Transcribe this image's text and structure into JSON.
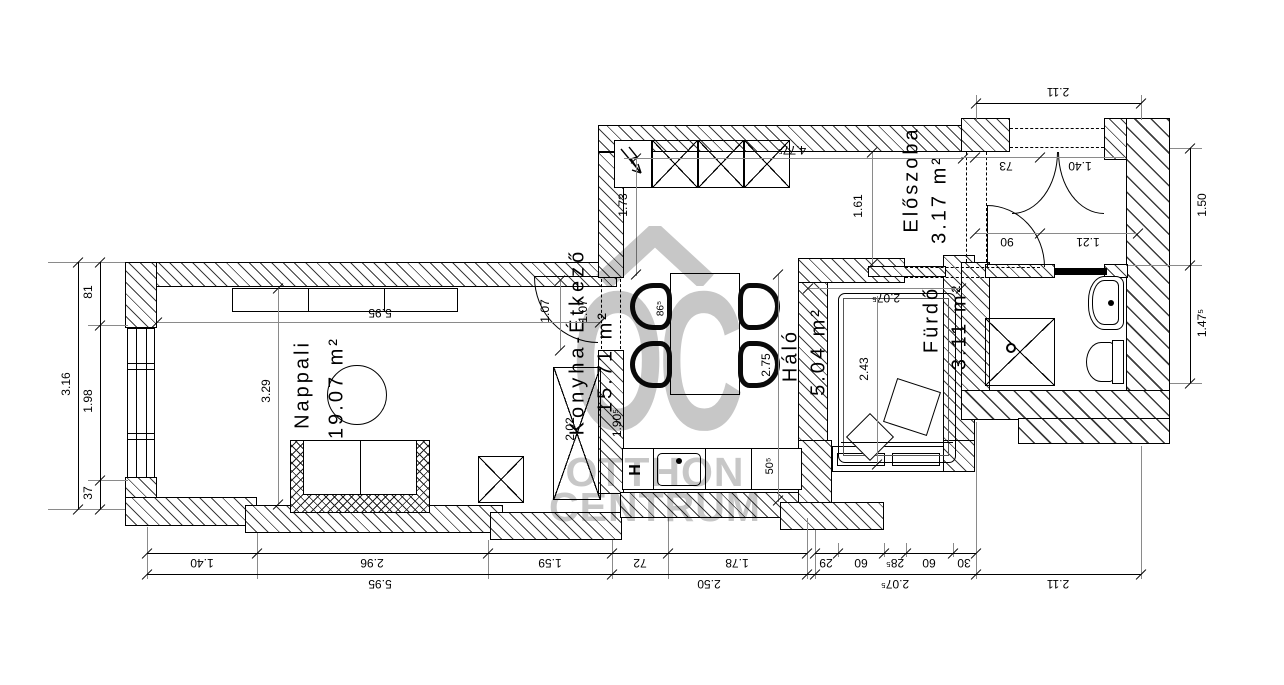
{
  "watermark": {
    "logo": "OC",
    "line1": "OTTHON",
    "line2": "CENTRUM",
    "color": "#c7c7c7"
  },
  "rooms": {
    "nappali": {
      "name": "Nappali",
      "area": "19.07 m²"
    },
    "konyha": {
      "name": "Konyha-Étkező",
      "area": "15.71 m²"
    },
    "halo": {
      "name": "Háló",
      "area": "5.04 m²"
    },
    "eloszoba": {
      "name": "Előszoba",
      "area": "3.17 m²"
    },
    "furdo": {
      "name": "Fürdő",
      "area": "3.11 m²"
    }
  },
  "dims": {
    "b1": [
      "1.40",
      "2.96",
      "1.59",
      "72",
      "1.78",
      "29",
      "60",
      "28⁵",
      "60",
      "30"
    ],
    "b2": [
      "5.95",
      "2.50",
      "2.07⁵",
      "2.11"
    ],
    "left": {
      "total": "3.16",
      "seg1": "81",
      "seg2": "1.98",
      "seg3": "37"
    },
    "right": {
      "seg1": "1.50",
      "seg2": "1.47⁵"
    },
    "top_right": "2.11",
    "inner": {
      "nappali_width": "5.95",
      "nappali_depth": "3.29",
      "door_nappali_a": "1.07",
      "door_nappali_b": "1.07",
      "wardrobe": "2.02",
      "counter_run": "1.90⁵",
      "kitchen_left": "1.73",
      "kitchen_width": "4.77⁵",
      "hall_strip": "1.61",
      "kitchen_depth": "2.75",
      "table_width": "86⁵",
      "counter_depth": "50⁵",
      "halo_width": "2.07⁵",
      "halo_depth": "2.43",
      "elo_opening": "73",
      "entry_door": "1.40",
      "bath_door": "90",
      "elo_width": "1.21",
      "fridge": "H"
    }
  }
}
